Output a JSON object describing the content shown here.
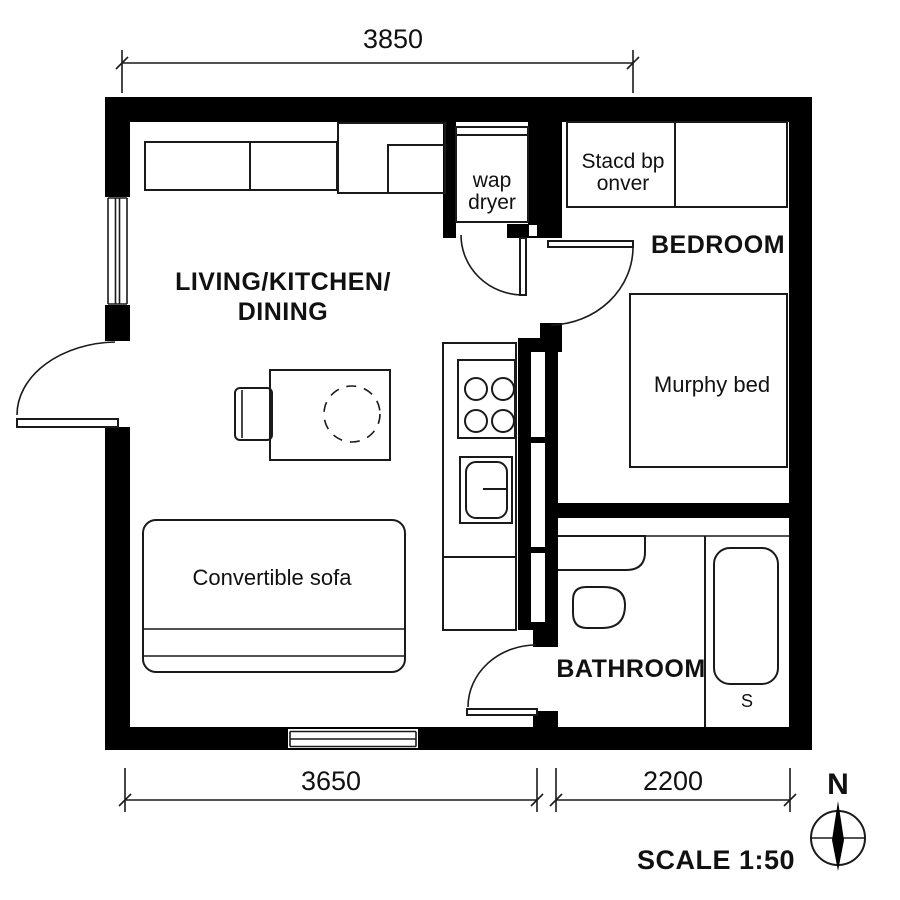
{
  "rooms": {
    "living": {
      "line1": "LIVING/KITCHEN/",
      "line2": "DINING"
    },
    "bedroom": {
      "label": "BEDROOM"
    },
    "bathroom": {
      "label": "BATHROOM"
    }
  },
  "furniture": {
    "sofa": "Convertible sofa",
    "murphy_bed": "Murphy bed",
    "washer_dryer": {
      "line1": "wap",
      "line2": "dryer"
    },
    "closet_unit": {
      "line1": "Stacd bp",
      "line2": "onver"
    },
    "shower_mark": "S"
  },
  "dimensions": {
    "top": "3850",
    "bottom_left": "3650",
    "bottom_right": "2200"
  },
  "annotations": {
    "scale": "SCALE 1:50",
    "north": "N"
  },
  "colors": {
    "wall": "#000000",
    "line": "#1a1a1a",
    "background": "#ffffff"
  }
}
